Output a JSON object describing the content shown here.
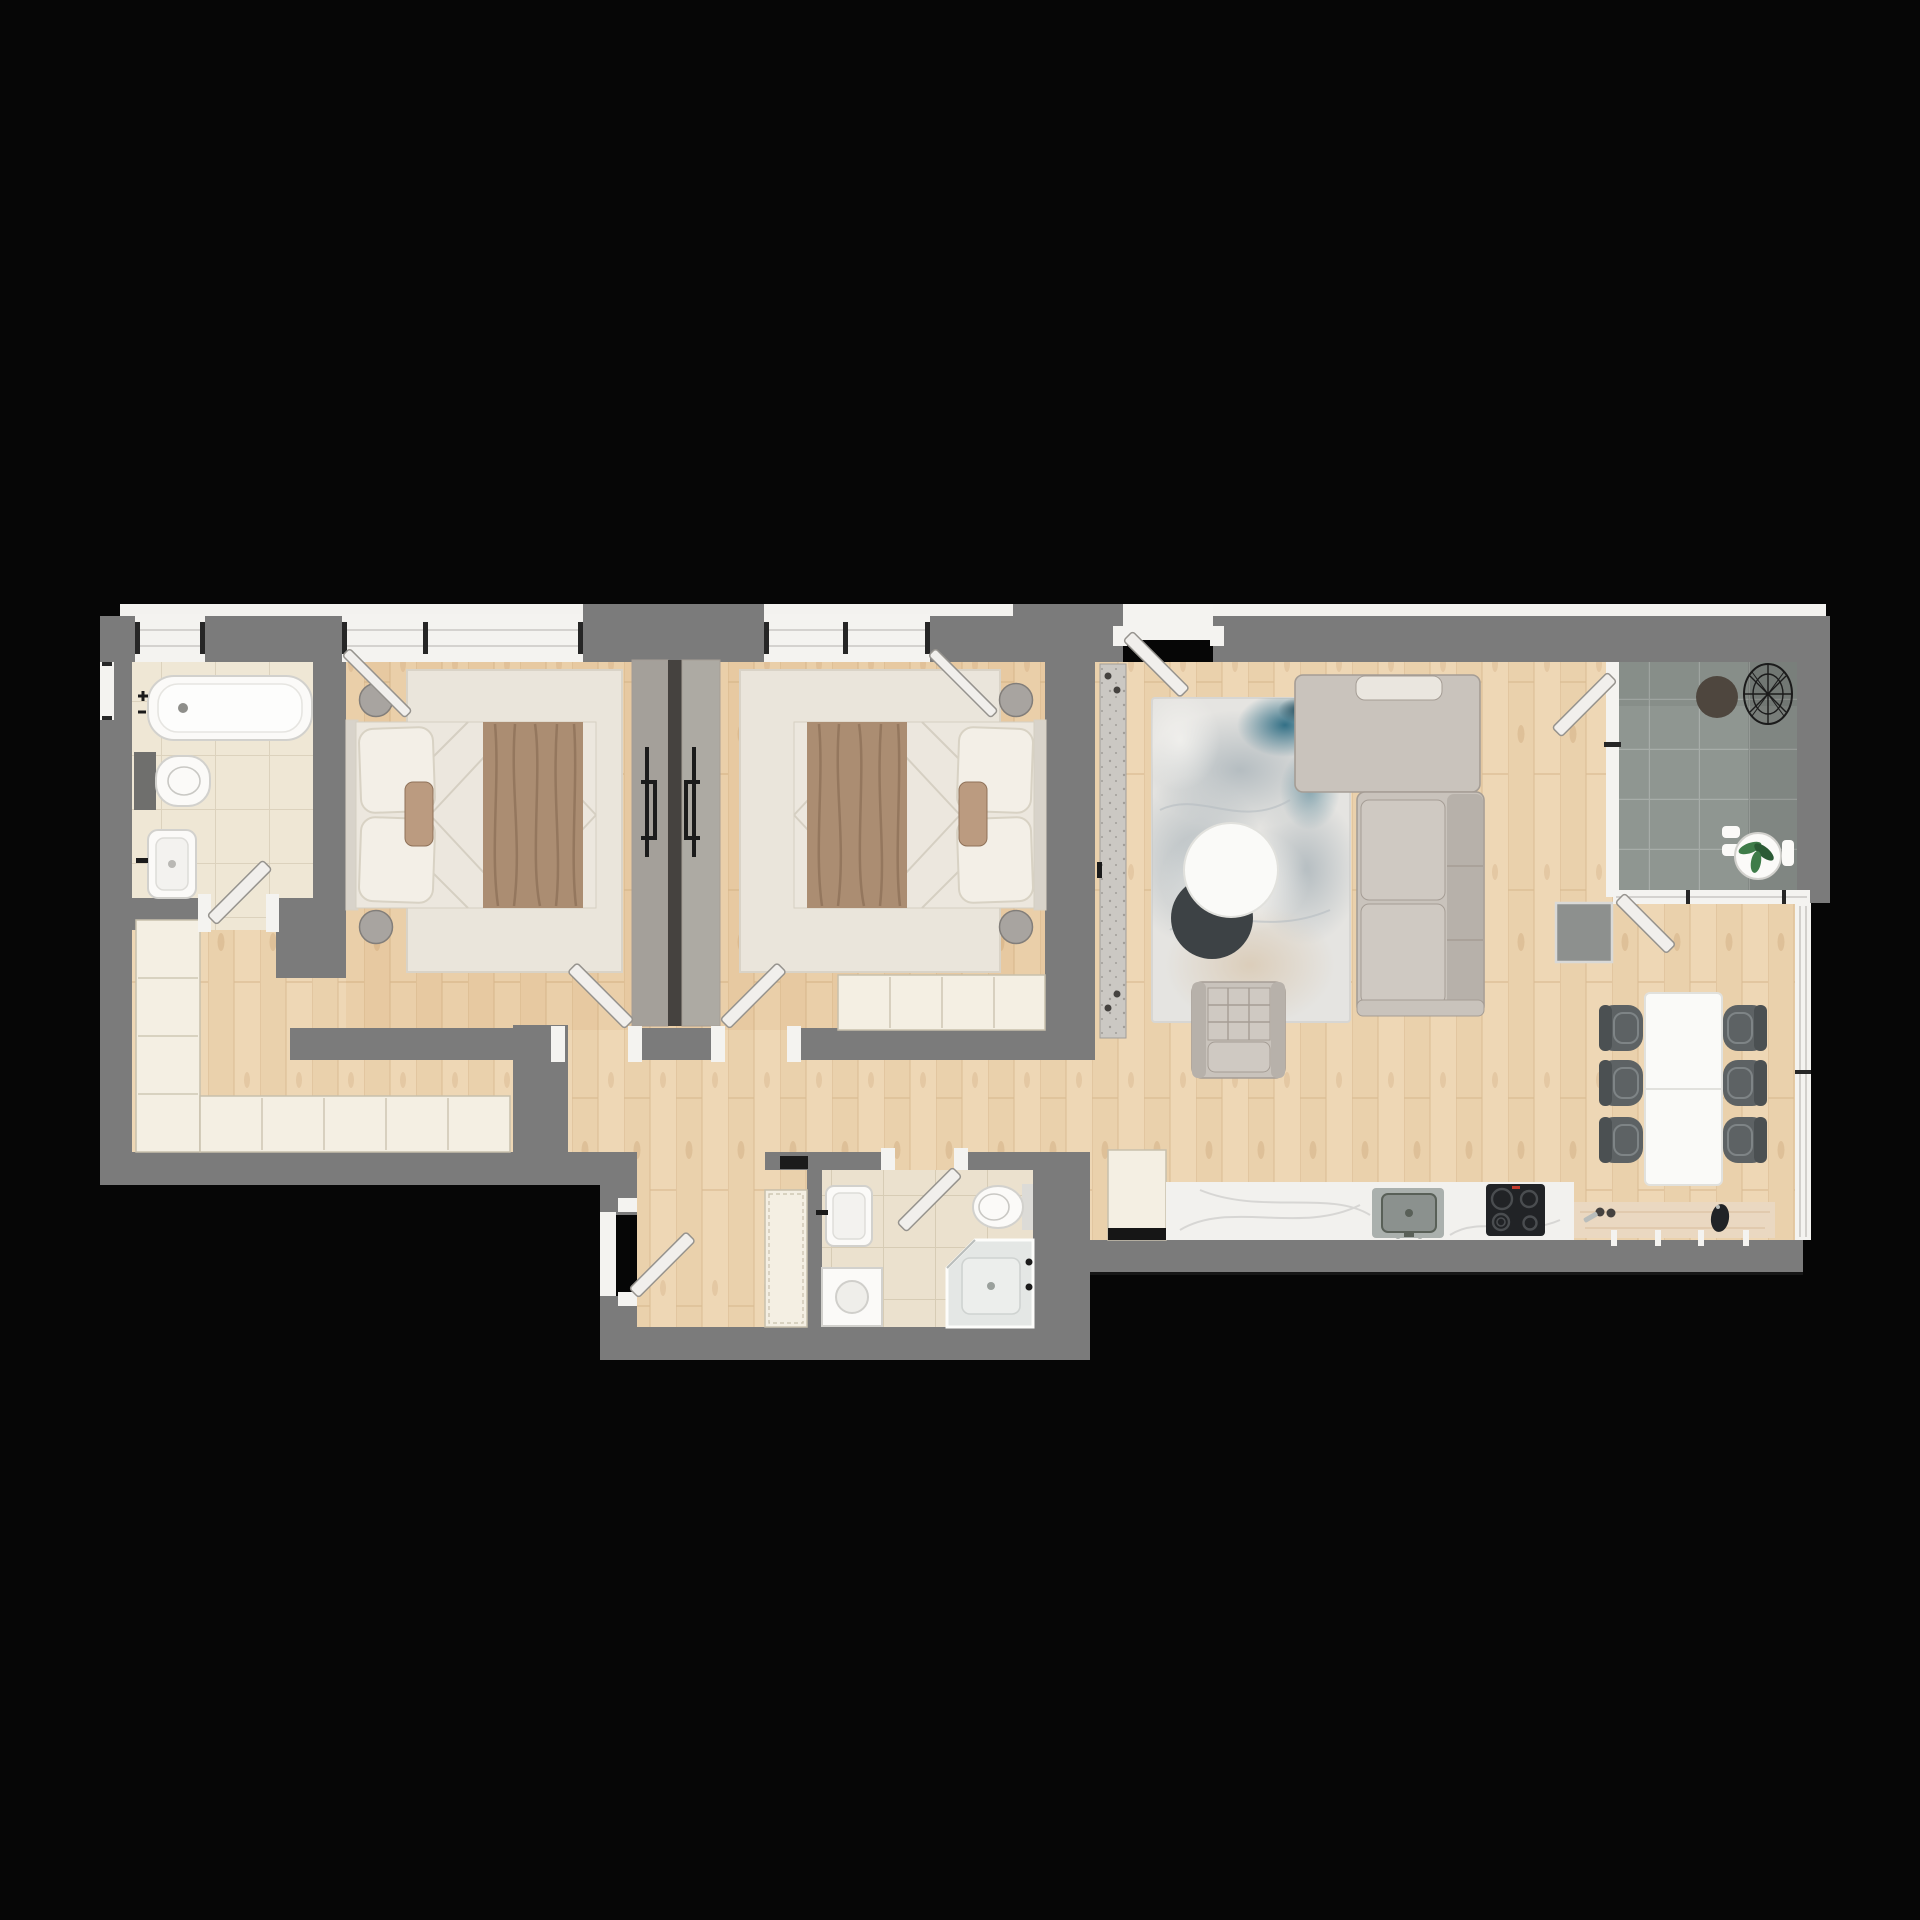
{
  "canvas": {
    "width": 1920,
    "height": 1920,
    "background": "#060606"
  },
  "colors": {
    "bg": "#060606",
    "wall": "#7b7b7b",
    "band": "#f3f2ef",
    "woodBase": "#eed7b5",
    "woodPlank": "#e7cba4",
    "woodSeam": "#d9bc92",
    "woodKnot": "#c7a173",
    "tileBathA": "#efe7d5",
    "groutA": "#dcd2bd",
    "tileBathB": "#ebe1ce",
    "groutB": "#d7ccb5",
    "balcTile": "#8f9691",
    "balcGrout": "#a7ada9",
    "rugBed": "#eae5db",
    "rugBedEdge": "#d9d3c7",
    "linen": "#ece7de",
    "quilt": "#d5cfc2",
    "throw": "#ab8d72",
    "throwDark": "#8f7259",
    "pillow": "#f3efe7",
    "pillowEdge": "#d8d2c4",
    "headboard": "#d8d3ca",
    "accentPillow": "#bb9b80",
    "stool": "#a8a4a0",
    "stoolEdge": "#827e7a",
    "wrA": "#a4a09a",
    "wrB": "#adaaa3",
    "wrSeam": "#45423f",
    "black": "#1b1b1b",
    "cab": "#f4efe3",
    "cabEdge": "#c8c0ac",
    "runner": "#cbc8c3",
    "speck": "#a19e99",
    "rugLiv": "#e5e4e1",
    "rugEdge": "#d7d6d3",
    "blobGray": "#b5bdc1",
    "blobTeal": "#337086",
    "blobNavy": "#1f4a5a",
    "blobBeige": "#d9c8b1",
    "blobWhite": "#f4f3f0",
    "sofa": "#c9c3bc",
    "sofaDark": "#b7b1aa",
    "sofaSeam": "#a59d95",
    "sofaPillow": "#eae6df",
    "sofaSeat": "#cfc9c2",
    "tableWhite": "#fafaf8",
    "tableEdge": "#e1e1dd",
    "shadowDark": "#3d4245",
    "chairBody": "#5d6264",
    "chairBack": "#4b5052",
    "chairSeat": "#7e8486",
    "marble": "#f2f1ee",
    "vein": "#d0cfcd",
    "cntWood": "#ead8c1",
    "cntGrain": "#d9bf9e",
    "sinkOut": "#aab0ad",
    "sinkIn": "#8b918e",
    "basin": "#596058",
    "cooktop": "#212326",
    "ring": "#4a4d50",
    "red": "#c23a2c",
    "ww": "#f4f3f0",
    "wline": "#c9c8c4",
    "tick": "#262626",
    "doorFill": "#f1efec",
    "doorStroke": "#96938e",
    "pan": "#e4e7e5",
    "glass": "#b9bdbb",
    "fixWhite": "#fbfaf8",
    "fixEdge": "#d2d1cd",
    "plant": "#3f7c49",
    "plantDark": "#2b5a35",
    "mat": "#8d908e",
    "matEdge": "#d9d9d7",
    "tintWarm": "rgba(206,138,66,0.10)",
    "shade": "rgba(0,0,0,0.10)",
    "darkline": "#161616"
  },
  "plan": {
    "type": "apartment-floor-plan-top-view",
    "rooms": [
      {
        "name": "main-bathroom",
        "furniture": [
          "bathtub",
          "wall-hung-toilet",
          "washbasin",
          "swing-door",
          "window"
        ]
      },
      {
        "name": "bedroom-1",
        "furniture": [
          "double-bed",
          "bed-pillows",
          "throw-blanket",
          "area-rug",
          "round-stool",
          "round-stool",
          "sliding-wardrobe",
          "window",
          "tilted-window-sash",
          "swing-door"
        ]
      },
      {
        "name": "bedroom-2",
        "furniture": [
          "double-bed",
          "bed-pillows",
          "throw-blanket",
          "area-rug",
          "round-stool",
          "round-stool",
          "sliding-wardrobe",
          "low-dresser",
          "window",
          "tilted-window-sash",
          "swing-door"
        ]
      },
      {
        "name": "hallway",
        "furniture": [
          "tall-cabinet-column",
          "cabinet-row",
          "entry-runner"
        ]
      },
      {
        "name": "lower-corridor",
        "furniture": [
          "tall-cabinet",
          "swing-door",
          "wall-vent"
        ]
      },
      {
        "name": "second-bathroom",
        "furniture": [
          "washbasin",
          "toilet",
          "corner-shower",
          "washing-machine",
          "swing-door"
        ]
      },
      {
        "name": "living-room",
        "furniture": [
          "corner-sofa",
          "sofa-pillow",
          "lounge-armchair",
          "round-coffee-table",
          "coffee-table-shadow-tier",
          "abstract-rug",
          "entrance-door"
        ]
      },
      {
        "name": "dining-area",
        "furniture": [
          "dining-table",
          "dining-chair",
          "dining-chair",
          "dining-chair",
          "dining-chair",
          "dining-chair",
          "dining-chair",
          "balcony-doormat",
          "balcony-door"
        ]
      },
      {
        "name": "kitchen",
        "furniture": [
          "tall-fridge-cabinet",
          "marble-countertop",
          "kitchen-sink",
          "induction-cooktop",
          "wood-counter",
          "salt-pepper-shakers",
          "serving-board"
        ]
      },
      {
        "name": "balcony",
        "furniture": [
          "round-outdoor-rug",
          "wire-chair",
          "plant-pot",
          "side-table-parts",
          "glazed-partition",
          "partition-door"
        ]
      }
    ]
  }
}
